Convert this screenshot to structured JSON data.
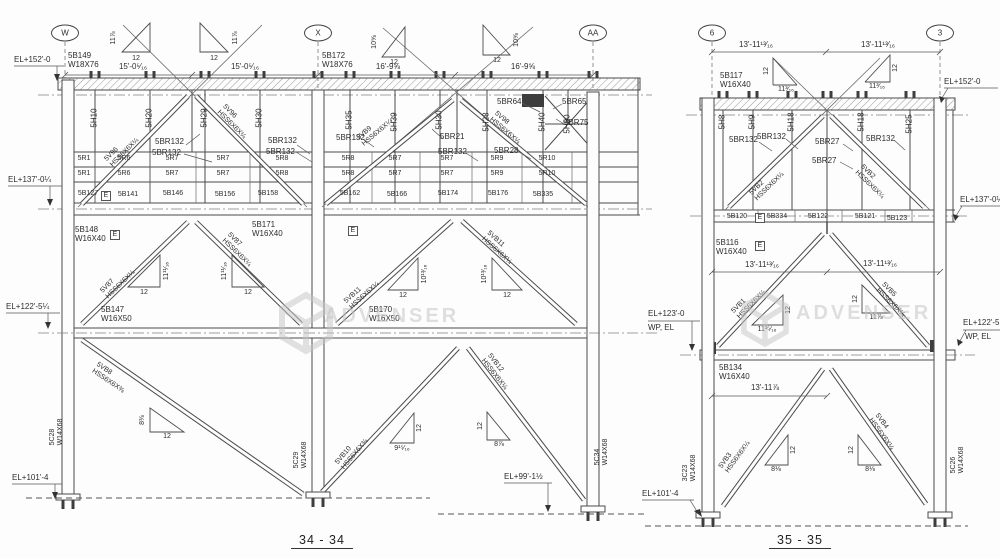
{
  "wm": {
    "text": "ADVENSER"
  },
  "sym": {
    "e": "E"
  },
  "l": {
    "title": "34 - 34",
    "grids": [
      "W",
      "X",
      "AA"
    ],
    "el": [
      "EL+152'-0",
      "EL+137'-0¼",
      "EL+122'-5¼",
      "EL+101'-4",
      "EL+99'-1½"
    ],
    "dims": [
      "15'-0⁵⁄₁₆",
      "15'-0⁵⁄₁₆",
      "16'-9⅝",
      "16'-9⅝"
    ],
    "girders": [
      [
        "5B149",
        "W18X76"
      ],
      [
        "5B172",
        "W18X76"
      ]
    ],
    "beams": [
      [
        "5B148",
        "W16X40"
      ],
      [
        "5B171",
        "W16X40"
      ],
      [
        "5B147",
        "W16X50"
      ],
      [
        "5B170",
        "W16X50"
      ]
    ],
    "cols": [
      [
        "5C28",
        "W14X68"
      ],
      [
        "5C29",
        "W14X68"
      ],
      [
        "5C34",
        "W14X68"
      ]
    ],
    "verts": [
      "5H10",
      "5H20",
      "5H29",
      "5H30",
      "5H35",
      "5H39",
      "5H30",
      "5H28",
      "5H40",
      "5H50"
    ],
    "row1": [
      "5R1",
      "5R6",
      "5R7",
      "5R7",
      "5R8",
      "5R8",
      "5R7",
      "5R7",
      "5R9",
      "5R10"
    ],
    "row2": [
      "5R1",
      "5R6",
      "5R7",
      "5R7",
      "5R8",
      "5R8",
      "5R7",
      "5R7",
      "5R9",
      "5R10"
    ],
    "bbeams": [
      "5B127",
      "5B141",
      "5B146",
      "5B156",
      "5B158",
      "5B162",
      "5B166",
      "5B174",
      "5B176",
      "5B335"
    ],
    "brs": [
      "5BR132",
      "5BR132",
      "5BR132",
      "5BR132",
      "5BR132",
      "5BR21",
      "5BR132",
      "5BR28",
      "5BR64",
      "5BR65",
      "5BR75"
    ],
    "diags": [
      [
        "5V96",
        "HSS6X6X¼"
      ],
      [
        "5V96",
        "HSS6X6X¼"
      ],
      [
        "5VB9",
        "HSS6X6X¼"
      ],
      [
        "5V98",
        "HSS6X6X¼"
      ],
      [
        "5V87",
        "HSS6X6X¼"
      ],
      [
        "5V87",
        "HSS6X6X¼"
      ],
      [
        "5VB11",
        "HSS6X6X¼"
      ],
      [
        "5VB11",
        "HSS6X6X¼"
      ],
      [
        "5VB8",
        "HSS6X6X⅜"
      ],
      [
        "5VB10",
        "HSS6X6X⅜"
      ],
      [
        "5VB12",
        "HSS6X6X¼"
      ]
    ],
    "tri_rise": [
      "11⅞",
      "11⅞",
      "10⅝",
      "10⅝",
      "11¹¹⁄₁₆",
      "11¹¹⁄₁₆",
      "10¹³⁄₁₆",
      "10¹³⁄₁₆",
      "8⅜",
      "9¹⁵⁄₁₆",
      "8⅞"
    ],
    "tri_run": "12"
  },
  "r": {
    "title": "35 - 35",
    "grids": [
      "6",
      "3"
    ],
    "el": [
      "EL+152'-0",
      "EL+137'-0¼",
      "EL+123'-0",
      "EL+122'-5",
      "EL+101'-4"
    ],
    "wp": "WP, EL",
    "dims": [
      "13'-11¹³⁄₁₆",
      "13'-11¹³⁄₁₆",
      "13'-11¹³⁄₁₆",
      "13'-11¹³⁄₁₆",
      "13'-11⅞"
    ],
    "girder": [
      "5B117",
      "W16X40"
    ],
    "beams": [
      [
        "5B116",
        "W16X40"
      ],
      [
        "5B134",
        "W16X40"
      ]
    ],
    "cols": [
      [
        "3C23",
        "W14X68"
      ],
      [
        "5C26",
        "W14X68"
      ]
    ],
    "verts": [
      "5H8",
      "5H9",
      "5H18",
      "5H18",
      "5H25"
    ],
    "bbeams": [
      "5B120",
      "5B334",
      "5B122",
      "5B121",
      "5B123"
    ],
    "brs": [
      "5BR132",
      "5BR132",
      "5BR27",
      "5BR27",
      "5BR132"
    ],
    "diags": [
      [
        "5VB2",
        "HSS6X6X¼"
      ],
      [
        "5VB2",
        "HSS6X6X¼"
      ],
      [
        "5VB1",
        "HSS6X6X¼"
      ],
      [
        "5VB5",
        "HSS6X6X¼"
      ],
      [
        "5VB3",
        "HSS6X6X¼"
      ],
      [
        "5VB4",
        "HSS6X6X¼"
      ]
    ],
    "tri_rise": [
      "11³⁄₁₆",
      "11³⁄₁₆",
      "11¹⁵⁄₁₆",
      "11⅞",
      "8⅛",
      "8⅛"
    ],
    "tri_run": "12"
  }
}
